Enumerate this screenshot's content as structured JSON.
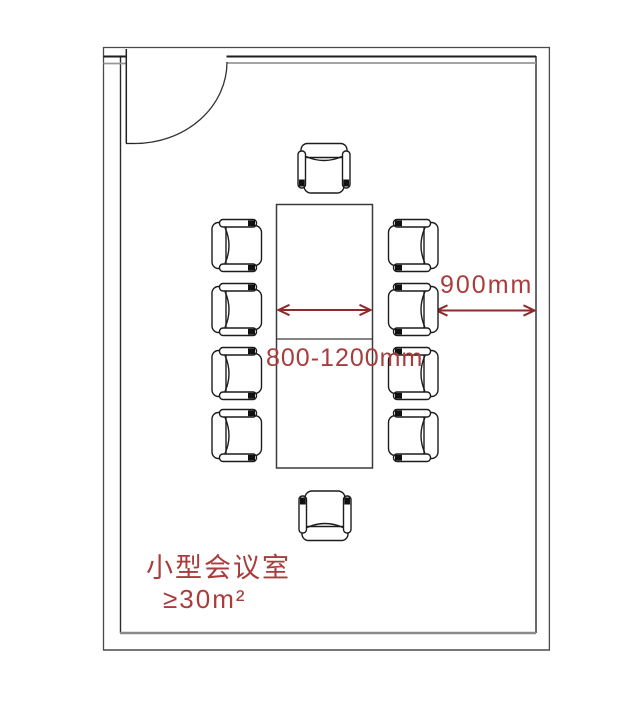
{
  "colors": {
    "accent_red": "#a93c3c",
    "arrow_red": "#8e2a2a",
    "wall_dark": "#2a2a2a",
    "wall_gray": "#8a8a8a",
    "chair_line": "#1c1c1c",
    "background": "#ffffff"
  },
  "labels": {
    "room_name": "小型会议室",
    "min_area": "≥30m²",
    "table_width_dim": "800-1200mm",
    "side_clearance_dim": "900mm"
  },
  "furniture": {
    "table": "conference-table",
    "chairs_total": 10,
    "chairs_left": 4,
    "chairs_right": 4,
    "chairs_top": 1,
    "chairs_bottom": 1
  }
}
